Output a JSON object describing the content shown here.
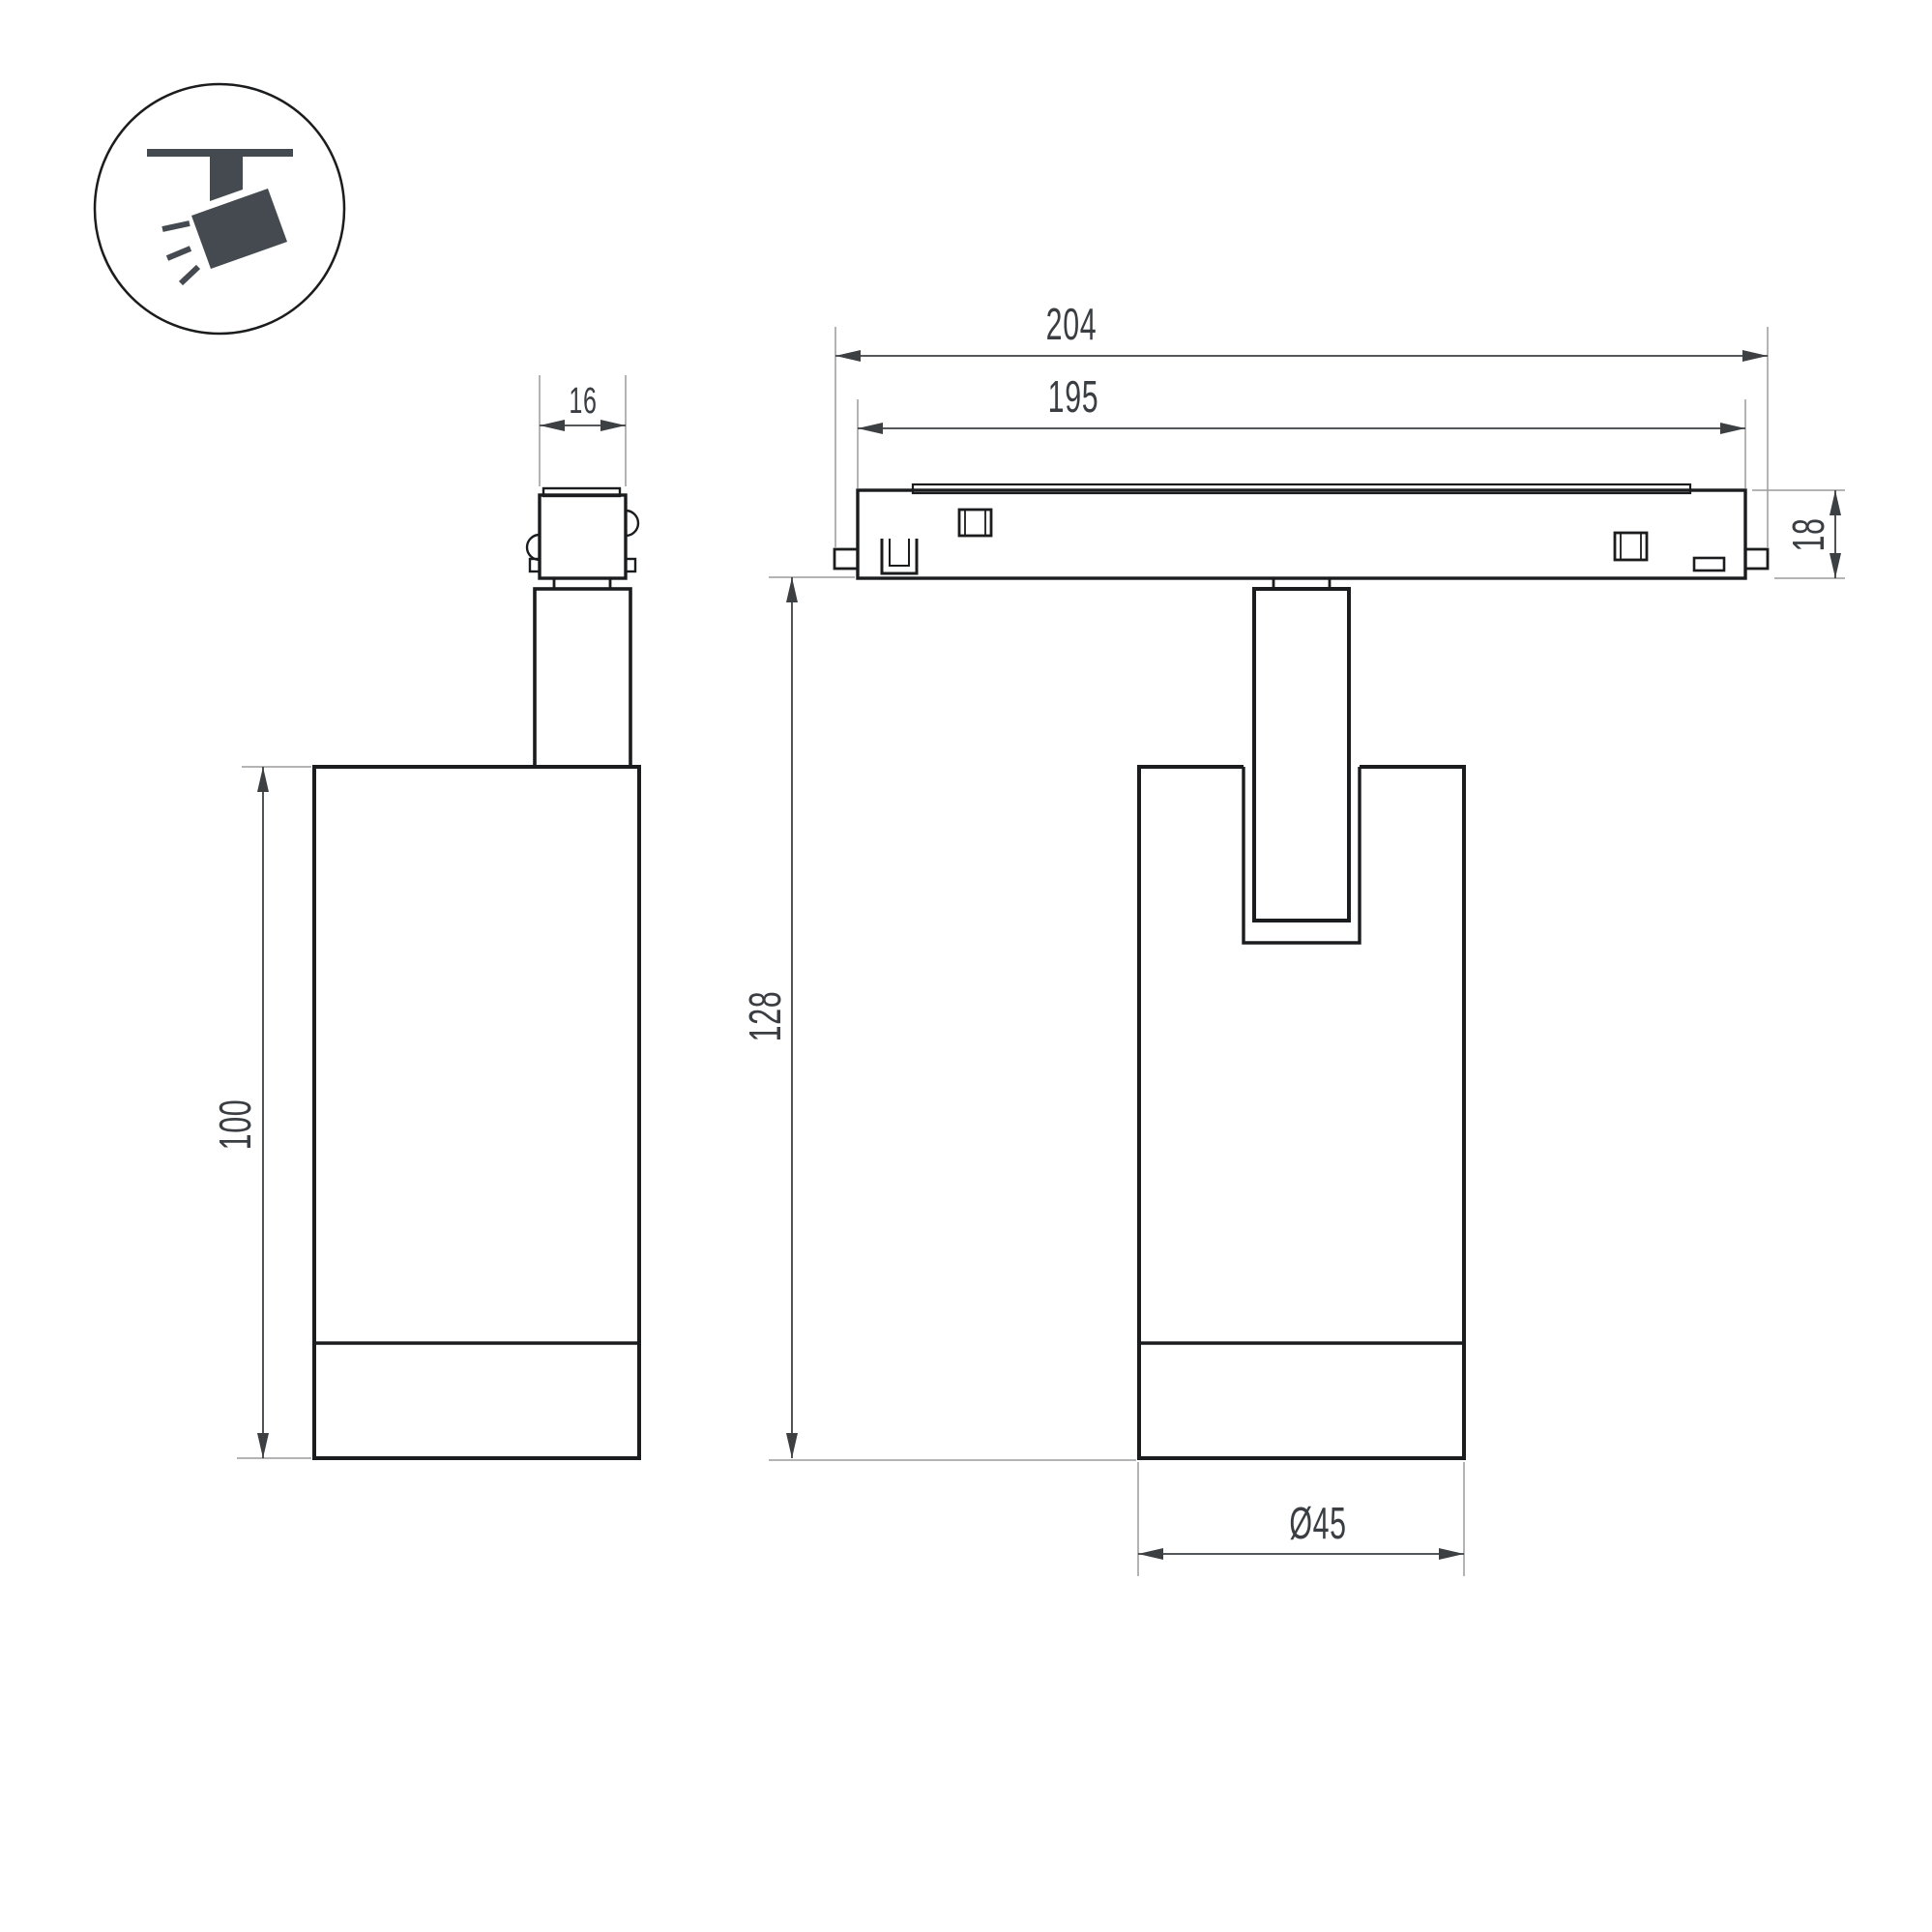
{
  "drawing": {
    "type": "luminaire-dimension-drawing",
    "views": {
      "icon_badge": "track-mounted adjustable spotlight pictogram",
      "left": "side view of spotlight with track adapter",
      "right": "front view of spotlight on track section"
    },
    "dimensions": {
      "adapter_width": "16",
      "body_height": "100",
      "track_length_overall": "204",
      "track_length_inner": "195",
      "track_height": "18",
      "overall_height": "128",
      "body_diameter": "Ø45"
    },
    "colors": {
      "background": "#ffffff",
      "object_line": "#1b1c1e",
      "dimension_line": "#3c4043",
      "extension_line": "#9b9b9b",
      "icon_fill": "#454a50"
    }
  }
}
